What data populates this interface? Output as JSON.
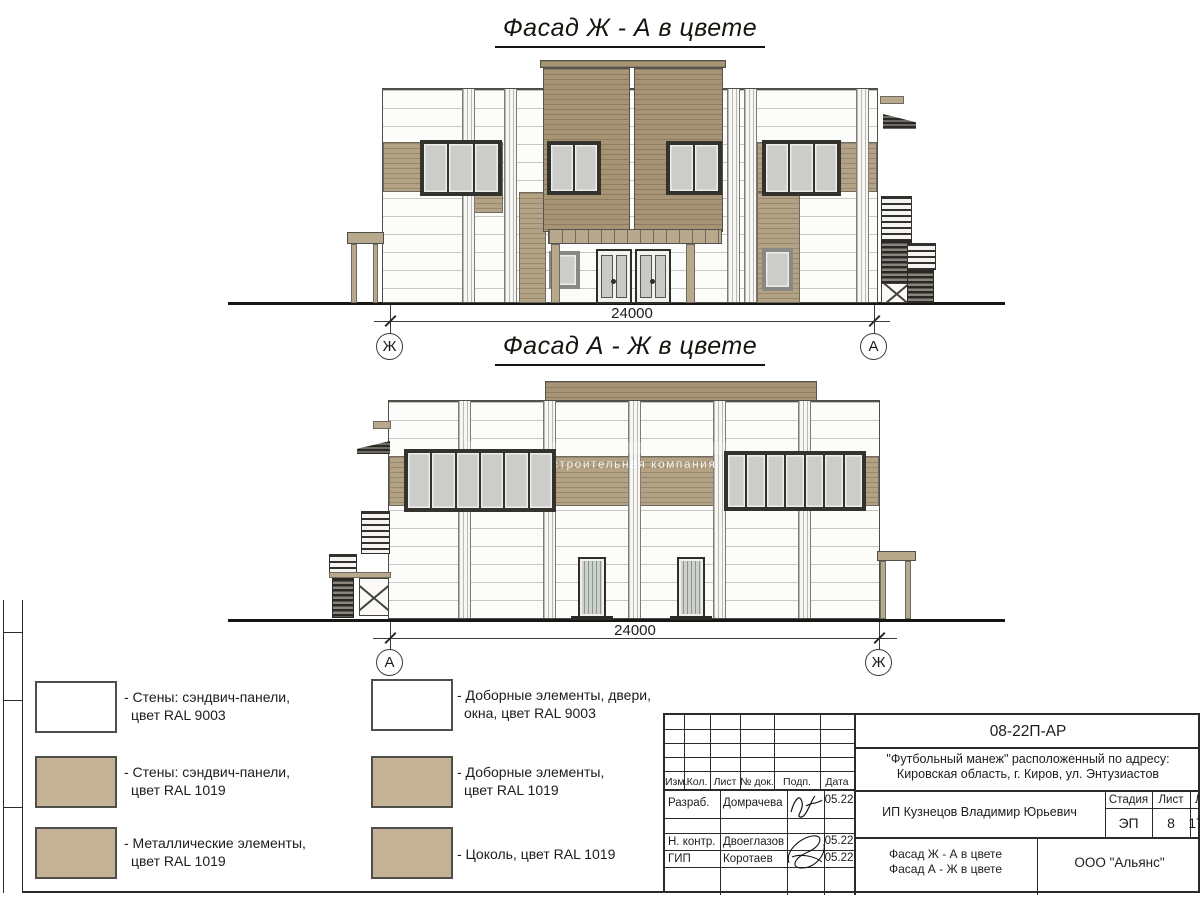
{
  "facade1": {
    "title": "Фасад Ж - А в цвете",
    "dimension": "24000",
    "axis_left": "Ж",
    "axis_right": "А"
  },
  "facade2": {
    "title": "Фасад А - Ж в цвете",
    "dimension": "24000",
    "axis_left": "А",
    "axis_right": "Ж"
  },
  "watermark": {
    "text": "строительная компания"
  },
  "colors": {
    "wall_white": "#fcfcfa",
    "panel_tan": "#b3a284",
    "tower_tan": "#a69474",
    "legend_tan": "#c4b396",
    "window_glass": "#cccccb"
  },
  "legend": {
    "items": [
      {
        "color": "#ffffff",
        "line1": "- Стены: сэндвич-панели,",
        "line2": "цвет RAL 9003"
      },
      {
        "color": "#c4b396",
        "line1": "- Стены: сэндвич-панели,",
        "line2": "цвет RAL 1019"
      },
      {
        "color": "#c4b396",
        "line1": "- Металлические элементы,",
        "line2": "цвет RAL 1019"
      },
      {
        "color": "#ffffff",
        "line1": "- Доборные элементы, двери,",
        "line2": "окна, цвет RAL 9003"
      },
      {
        "color": "#c4b396",
        "line1": "- Доборные элементы,",
        "line2": "цвет RAL 1019"
      },
      {
        "color": "#c4b396",
        "line1": "- Цоколь, цвет RAL 1019",
        "line2": ""
      }
    ]
  },
  "titleblock": {
    "doc_number": "08-22П-АР",
    "project_line1": "\"Футбольный манеж\" расположенный по адресу:",
    "project_line2": "Кировская область, г. Киров, ул. Энтузиастов",
    "columns": [
      "Изм.",
      "Кол.",
      "Лист",
      "№ док.",
      "Подп.",
      "Дата"
    ],
    "rows": [
      {
        "role": "Разраб.",
        "name": "Домрачева",
        "date": "05.22"
      },
      {
        "role": "Н. контр.",
        "name": "Двоеглазов",
        "date": "05.22"
      },
      {
        "role": "ГИП",
        "name": "Коротаев",
        "date": "05.22"
      }
    ],
    "client": "ИП Кузнецов Владимир Юрьевич",
    "stage_label": "Стадия",
    "sheet_label": "Лист",
    "sheets_label": "Листов",
    "stage": "ЭП",
    "sheet": "8",
    "sheets": "17",
    "sheet_title_line1": "Фасад Ж - А в цвете",
    "sheet_title_line2": "Фасад А - Ж в цвете",
    "company": "ООО \"Альянс\""
  }
}
